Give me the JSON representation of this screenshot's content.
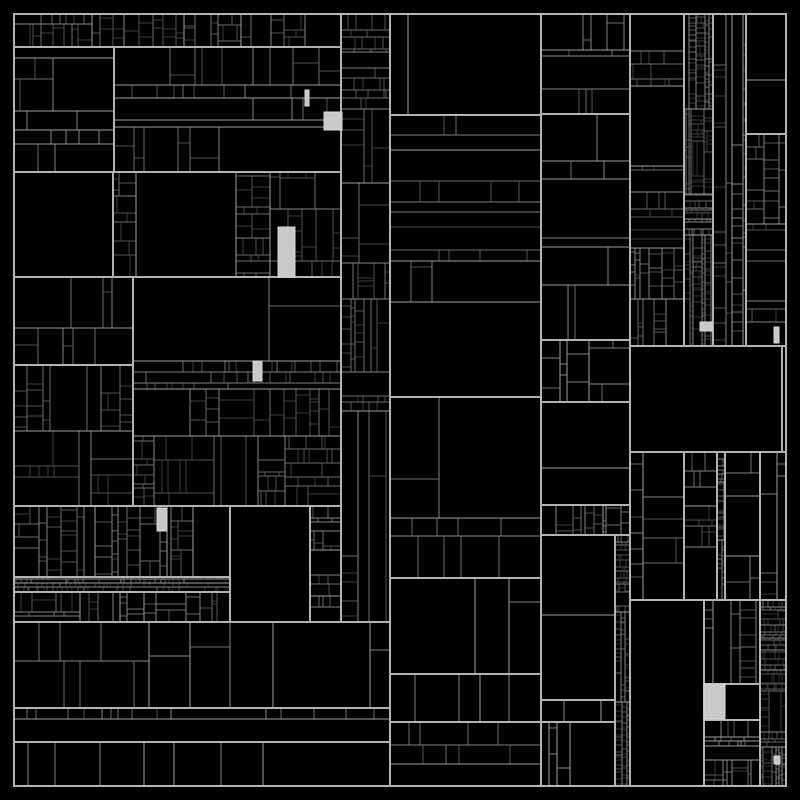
{
  "meta": {
    "description": "Abstract monochrome treemap visualization, black cells with gray hairline borders and a few light-gray highlighted cells",
    "visible_text": []
  },
  "chart_data": {
    "type": "treemap",
    "title": "",
    "xlabel": "",
    "ylabel": "",
    "values_visible": false,
    "labels_visible": false,
    "bounds": {
      "x": 14,
      "y": 14,
      "width": 772,
      "height": 772
    },
    "style": {
      "background": "#000000",
      "cell_fill": "#000000",
      "outer_border_color": "#b4b4b4",
      "depth_border_colors": [
        "#b2b2b2",
        "#9e9e9e",
        "#858585",
        "#6b6b6b",
        "#525252",
        "#3d3d3d",
        "#2f2f2f"
      ],
      "highlight_fill": "#c9c9c9",
      "highlight_border": "#d9d9d9"
    },
    "regions": [
      {
        "name": "top-strip",
        "x": 14,
        "y": 14,
        "w": 327,
        "h": 33,
        "density": "fine",
        "orient": "v",
        "seed": 101
      },
      {
        "name": "narrow-col-mid",
        "x": 341,
        "y": 14,
        "w": 49,
        "h": 608,
        "density": "fine",
        "orient": "h",
        "seed": 102
      },
      {
        "name": "upper-left-a",
        "x": 14,
        "y": 47,
        "w": 100,
        "h": 125,
        "density": "medium",
        "orient": "auto",
        "seed": 103
      },
      {
        "name": "upper-left-b",
        "x": 114,
        "y": 47,
        "w": 227,
        "h": 125,
        "density": "medium",
        "orient": "auto",
        "seed": 104
      },
      {
        "name": "big-empty-left",
        "x": 14,
        "y": 172,
        "w": 99,
        "h": 105,
        "density": "leaf",
        "orient": "auto",
        "seed": 105
      },
      {
        "name": "mid-left-dense",
        "x": 113,
        "y": 172,
        "w": 228,
        "h": 105,
        "density": "fine",
        "orient": "auto",
        "seed": 106
      },
      {
        "name": "left-block-c",
        "x": 14,
        "y": 277,
        "w": 119,
        "h": 88,
        "density": "medium",
        "orient": "auto",
        "seed": 107
      },
      {
        "name": "left-block-d",
        "x": 14,
        "y": 365,
        "w": 119,
        "h": 141,
        "density": "fine",
        "orient": "auto",
        "seed": 108
      },
      {
        "name": "center-dense-block",
        "x": 133,
        "y": 277,
        "w": 208,
        "h": 229,
        "density": "fine",
        "orient": "auto",
        "seed": 109
      },
      {
        "name": "left-strip-e",
        "x": 14,
        "y": 506,
        "w": 216,
        "h": 71,
        "density": "fine",
        "orient": "v",
        "seed": 110
      },
      {
        "name": "thin-row",
        "x": 14,
        "y": 577,
        "w": 216,
        "h": 15,
        "density": "ultrafine",
        "orient": "v",
        "seed": 111
      },
      {
        "name": "left-strip-f",
        "x": 14,
        "y": 592,
        "w": 216,
        "h": 30,
        "density": "fine",
        "orient": "v",
        "seed": 112
      },
      {
        "name": "big-empty-center",
        "x": 230,
        "y": 506,
        "w": 80,
        "h": 116,
        "density": "leaf",
        "orient": "auto",
        "seed": 113
      },
      {
        "name": "narrow-block",
        "x": 310,
        "y": 506,
        "w": 31,
        "h": 116,
        "density": "fine",
        "orient": "h",
        "seed": 114
      },
      {
        "name": "bottom-left-big",
        "x": 14,
        "y": 622,
        "w": 376,
        "h": 86,
        "density": "coarse",
        "orient": "v",
        "seed": 115
      },
      {
        "name": "bottom-left-row",
        "x": 14,
        "y": 708,
        "w": 376,
        "h": 34,
        "density": "medium",
        "orient": "v",
        "seed": 116
      },
      {
        "name": "bottom-left-base",
        "x": 14,
        "y": 742,
        "w": 376,
        "h": 44,
        "density": "coarse",
        "orient": "v",
        "seed": 117
      },
      {
        "name": "col1-top",
        "x": 390,
        "y": 14,
        "w": 151,
        "h": 101,
        "density": "medium",
        "orient": "auto",
        "seed": 118
      },
      {
        "name": "col1-tall",
        "x": 390,
        "y": 115,
        "w": 151,
        "h": 282,
        "density": "medium",
        "orient": "h",
        "seed": 119
      },
      {
        "name": "col1-mid",
        "x": 390,
        "y": 397,
        "w": 151,
        "h": 181,
        "density": "coarse",
        "orient": "auto",
        "seed": 120
      },
      {
        "name": "col1-bigcells",
        "x": 390,
        "y": 578,
        "w": 151,
        "h": 96,
        "density": "xcoarse",
        "orient": "v",
        "seed": 121
      },
      {
        "name": "col1-row",
        "x": 390,
        "y": 674,
        "w": 151,
        "h": 48,
        "density": "coarse",
        "orient": "v",
        "seed": 122
      },
      {
        "name": "col1-bottom",
        "x": 390,
        "y": 722,
        "w": 151,
        "h": 64,
        "density": "medium",
        "orient": "h",
        "seed": 123
      },
      {
        "name": "col2-top",
        "x": 541,
        "y": 14,
        "w": 89,
        "h": 100,
        "density": "medium",
        "orient": "auto",
        "seed": 124
      },
      {
        "name": "col2-tall",
        "x": 541,
        "y": 114,
        "w": 89,
        "h": 226,
        "density": "coarse",
        "orient": "h",
        "seed": 125
      },
      {
        "name": "col2-mid",
        "x": 541,
        "y": 340,
        "w": 89,
        "h": 62,
        "density": "medium",
        "orient": "auto",
        "seed": 126
      },
      {
        "name": "col2-bigcells",
        "x": 541,
        "y": 402,
        "w": 89,
        "h": 103,
        "density": "xcoarse",
        "orient": "auto",
        "seed": 127
      },
      {
        "name": "col2-strip",
        "x": 541,
        "y": 505,
        "w": 89,
        "h": 30,
        "density": "fine",
        "orient": "v",
        "seed": 128
      },
      {
        "name": "col2-lower-big",
        "x": 541,
        "y": 535,
        "w": 74,
        "h": 165,
        "density": "xcoarse",
        "orient": "h",
        "seed": 129
      },
      {
        "name": "col2-lower-row",
        "x": 541,
        "y": 700,
        "w": 74,
        "h": 22,
        "density": "coarse",
        "orient": "h",
        "seed": 130
      },
      {
        "name": "col2-bottom",
        "x": 541,
        "y": 722,
        "w": 74,
        "h": 64,
        "density": "medium",
        "orient": "v",
        "seed": 131
      },
      {
        "name": "sliver-col",
        "x": 615,
        "y": 535,
        "w": 15,
        "h": 251,
        "density": "ultrafine",
        "orient": "h",
        "seed": 132
      },
      {
        "name": "col3-tall",
        "x": 630,
        "y": 14,
        "w": 54,
        "h": 332,
        "density": "fine",
        "orient": "h",
        "seed": 133
      },
      {
        "name": "col4-slivers",
        "x": 684,
        "y": 14,
        "w": 29,
        "h": 332,
        "density": "ultrafine",
        "orient": "h",
        "seed": 134
      },
      {
        "name": "col5-tall",
        "x": 713,
        "y": 14,
        "w": 33,
        "h": 332,
        "density": "fine",
        "orient": "h",
        "seed": 135
      },
      {
        "name": "col6-top-empty",
        "x": 746,
        "y": 14,
        "w": 40,
        "h": 120,
        "density": "xcoarse",
        "orient": "h",
        "seed": 136
      },
      {
        "name": "col6-tall",
        "x": 746,
        "y": 134,
        "w": 40,
        "h": 212,
        "density": "fine",
        "orient": "h",
        "seed": 137
      },
      {
        "name": "black-band",
        "x": 630,
        "y": 346,
        "w": 152,
        "h": 106,
        "density": "leaf",
        "orient": "auto",
        "seed": 138
      },
      {
        "name": "black-band-sliver",
        "x": 782,
        "y": 346,
        "w": 4,
        "h": 106,
        "density": "leaf",
        "orient": "auto",
        "seed": 139
      },
      {
        "name": "midright-a",
        "x": 630,
        "y": 452,
        "w": 54,
        "h": 148,
        "density": "medium",
        "orient": "h",
        "seed": 140
      },
      {
        "name": "midright-b",
        "x": 684,
        "y": 452,
        "w": 33,
        "h": 148,
        "density": "fine",
        "orient": "h",
        "seed": 141
      },
      {
        "name": "midright-ladder",
        "x": 717,
        "y": 452,
        "w": 8,
        "h": 148,
        "density": "ultrafine",
        "orient": "h",
        "seed": 142
      },
      {
        "name": "midright-c",
        "x": 725,
        "y": 452,
        "w": 35,
        "h": 148,
        "density": "medium",
        "orient": "h",
        "seed": 143
      },
      {
        "name": "midright-d",
        "x": 760,
        "y": 452,
        "w": 26,
        "h": 148,
        "density": "fine",
        "orient": "h",
        "seed": 144
      },
      {
        "name": "bottomright-empty",
        "x": 630,
        "y": 600,
        "w": 74,
        "h": 186,
        "density": "leaf",
        "orient": "auto",
        "seed": 145
      },
      {
        "name": "bottomright-a",
        "x": 704,
        "y": 600,
        "w": 56,
        "h": 84,
        "density": "fine",
        "orient": "h",
        "seed": 146
      },
      {
        "name": "bottomright-hrow",
        "x": 704,
        "y": 684,
        "w": 56,
        "h": 36,
        "density": "coarse",
        "orient": "v",
        "seed": 147
      },
      {
        "name": "bottomright-b",
        "x": 704,
        "y": 720,
        "w": 56,
        "h": 66,
        "density": "fine",
        "orient": "h",
        "seed": 148
      },
      {
        "name": "bottomright-sliver",
        "x": 760,
        "y": 600,
        "w": 26,
        "h": 186,
        "density": "ultrafine",
        "orient": "h",
        "seed": 149
      }
    ],
    "highlights": [
      {
        "name": "selected-cell-1",
        "x": 324,
        "y": 112,
        "w": 18,
        "h": 18
      },
      {
        "name": "selected-cell-2",
        "x": 305,
        "y": 90,
        "w": 4,
        "h": 16
      },
      {
        "name": "selected-cell-3",
        "x": 278,
        "y": 227,
        "w": 17,
        "h": 50
      },
      {
        "name": "selected-cell-4",
        "x": 253,
        "y": 361,
        "w": 9,
        "h": 20
      },
      {
        "name": "selected-cell-5",
        "x": 157,
        "y": 508,
        "w": 10,
        "h": 23
      },
      {
        "name": "selected-cell-6",
        "x": 700,
        "y": 322,
        "w": 12,
        "h": 9
      },
      {
        "name": "selected-cell-7",
        "x": 774,
        "y": 327,
        "w": 5,
        "h": 16
      },
      {
        "name": "selected-cell-8",
        "x": 704,
        "y": 684,
        "w": 21,
        "h": 35
      },
      {
        "name": "selected-cell-9",
        "x": 774,
        "y": 756,
        "w": 6,
        "h": 8
      }
    ]
  }
}
